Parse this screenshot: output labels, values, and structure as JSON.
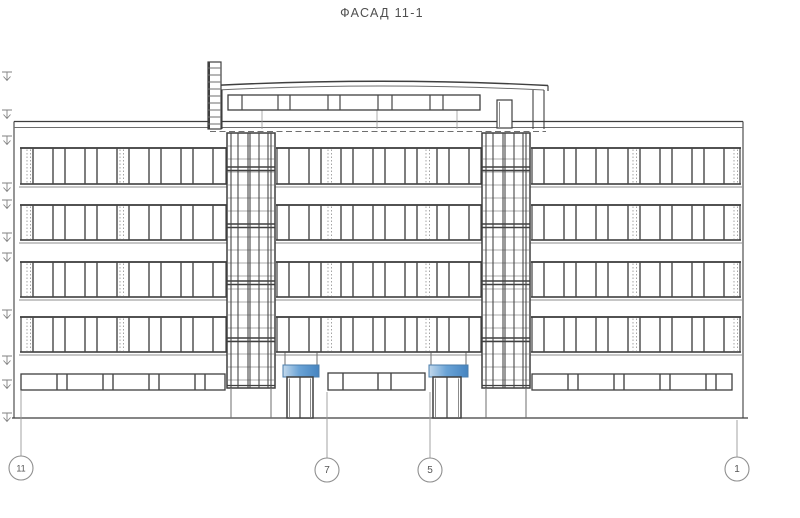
{
  "title": "ФАСАД 11-1",
  "canvas": {
    "width": 800,
    "height": 518
  },
  "colors": {
    "background": "#ffffff",
    "line_dark": "#3f3f3f",
    "line_mid": "#6e6e6e",
    "line_light": "#999999",
    "dotted": "#a3a3a3",
    "canopy_light": "#c3d9ec",
    "canopy_mid": "#6aa3d6",
    "canopy_dark": "#4584c0",
    "canopy_stroke": "#4b7dab",
    "text": "#4f4f4f"
  },
  "facade": {
    "left": 14,
    "right": 743,
    "parapet_y1": 121.5,
    "parapet_y2": 127.5,
    "ground_y": 418,
    "ground_x1": 12,
    "ground_x2": 748
  },
  "window_rows": [
    {
      "y": 148,
      "h": 36
    },
    {
      "y": 205,
      "h": 35
    },
    {
      "y": 262,
      "h": 35
    },
    {
      "y": 317,
      "h": 35
    }
  ],
  "blocks": [
    {
      "x": 21,
      "w": 205,
      "dotted": [
        27,
        120
      ]
    },
    {
      "x": 277,
      "w": 204,
      "dotted": [
        328,
        426
      ]
    },
    {
      "x": 532,
      "w": 208,
      "dotted": [
        633,
        734
      ]
    }
  ],
  "pane_pattern": [
    12,
    20
  ],
  "ground_bands": [
    {
      "x": 21,
      "w": 204
    },
    {
      "x": 532,
      "w": 200
    }
  ],
  "ground_band_y": 374,
  "ground_band_h": 16,
  "ground_pattern": [
    36,
    10
  ],
  "center_band": {
    "x": 328,
    "w": 97,
    "y": 373,
    "h": 17,
    "mullions": [
      343,
      378,
      391
    ]
  },
  "towers": [
    {
      "x": 227
    },
    {
      "x": 482
    }
  ],
  "tower": {
    "w": 48,
    "top": 133,
    "bottom": 388,
    "verticals": [
      4,
      11,
      21,
      23,
      32,
      41,
      44
    ],
    "thick_bands": [
      167,
      224,
      281,
      338
    ],
    "thin_start": 146,
    "thin_step": 13,
    "base_left": 4,
    "base_right": 44
  },
  "penthouse": {
    "roof": {
      "x1": 213,
      "x2": 548,
      "y": 85.5,
      "peak": 77,
      "under_y": 90,
      "under_peak": 82
    },
    "walls": [
      222,
      533,
      544
    ],
    "wall_top": 90,
    "wall_bottom": 129,
    "band": {
      "x": 228,
      "y": 95,
      "w": 252,
      "h": 15,
      "mullions": [
        242,
        278,
        290,
        328,
        340,
        378,
        392,
        430,
        443
      ]
    },
    "supports": [
      262,
      377,
      457
    ],
    "door": {
      "x": 497,
      "y": 100,
      "w": 15,
      "h": 28
    },
    "ladder": {
      "x": 208,
      "w": 13,
      "top": 62,
      "bottom": 129,
      "rung_start": 68,
      "rung_step": 7
    },
    "dash": {
      "y": 131.5,
      "x1": 210,
      "x2": 546
    }
  },
  "entrance": {
    "canopy_y": 365,
    "canopy_h": 12,
    "hanger_top": 352.5,
    "door_y": 377,
    "door_h": 41
  },
  "entrances": [
    {
      "canopy_x": 283,
      "canopy_w": 36,
      "door_x": 287,
      "door_w": 26
    },
    {
      "canopy_x": 429,
      "canopy_w": 39,
      "door_x": 433,
      "door_w": 28
    }
  ],
  "elevation_marks": [
    72,
    110,
    136,
    183,
    200,
    233,
    253,
    310,
    356,
    380,
    413
  ],
  "axes": [
    {
      "label": "11",
      "x": 21,
      "leader_top": 391,
      "cy": 468
    },
    {
      "label": "7",
      "x": 327,
      "leader_top": 392,
      "cy": 470
    },
    {
      "label": "5",
      "x": 430,
      "leader_top": 392,
      "cy": 470
    },
    {
      "label": "1",
      "x": 737,
      "leader_top": 420,
      "cy": 469
    }
  ],
  "axis_circle_r": 12
}
